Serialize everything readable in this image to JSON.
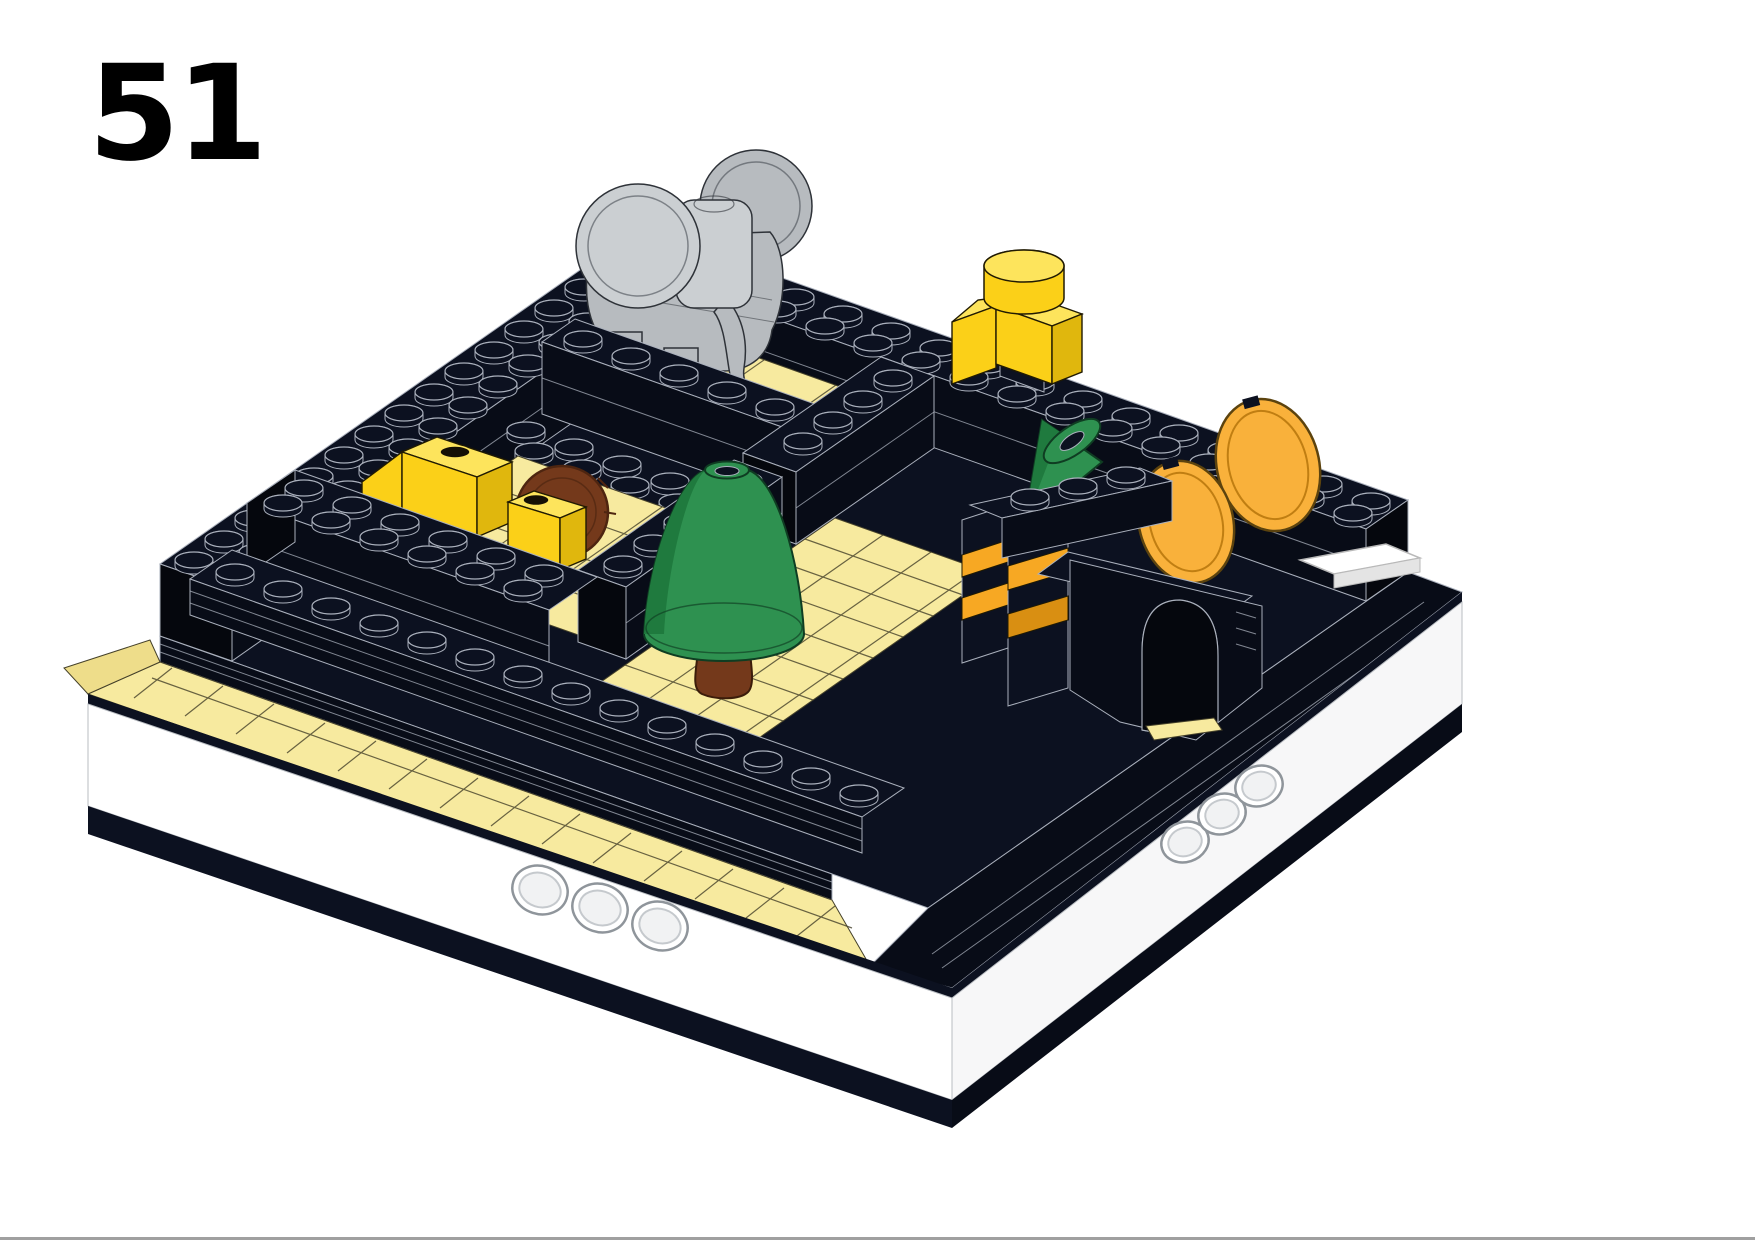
{
  "page": {
    "step_number": "51"
  },
  "palette": {
    "page_bg": "#ffffff",
    "ink": "#000000",
    "brick_black": "#0c1120",
    "brick_black_shade": "#080c17",
    "brick_black_dark": "#05070d",
    "edge": "#aab0bc",
    "tan": "#f7ea9f",
    "tan_bright": "#fbf2b6",
    "tan_face": "#eedd8a",
    "tan_line": "#45412a",
    "yellow": "#fbd018",
    "yellow_light": "#fde45c",
    "yellow_dark": "#e0b70d",
    "orange": "#f7a823",
    "orange_dark": "#d98f12",
    "orange_disc": "#f9b13b",
    "orange_disc_rim": "#c07e12",
    "green": "#2e9150",
    "green_dark": "#1f7a3e",
    "green_line": "#0f3d22",
    "brown": "#74391b",
    "brown_dark": "#4e2510",
    "gray": "#b7bbbf",
    "gray_light": "#cbcfd2",
    "gray_dark": "#999ea3",
    "outline": "#2e3238",
    "white_tile": "#ffffff",
    "divider": "#a0a0a0"
  },
  "scene_parts": [
    {
      "name": "baseplate",
      "color_key": "brick_black"
    },
    {
      "name": "tile-border",
      "color_key": "tan"
    },
    {
      "name": "elephant-figure",
      "color_key": "gray"
    },
    {
      "name": "lioness-figure",
      "color_key": "yellow"
    },
    {
      "name": "lion-figure-with-mane",
      "color_key": "brown"
    },
    {
      "name": "conifer-tree",
      "color_key": "green"
    },
    {
      "name": "tilted-small-cone",
      "color_key": "green"
    },
    {
      "name": "striped-gate-with-arch",
      "color_key": "orange"
    },
    {
      "name": "round-orange-discs",
      "color_key": "orange_disc"
    },
    {
      "name": "yellow-head-figure",
      "color_key": "yellow"
    },
    {
      "name": "white-tile",
      "color_key": "white_tile"
    }
  ]
}
